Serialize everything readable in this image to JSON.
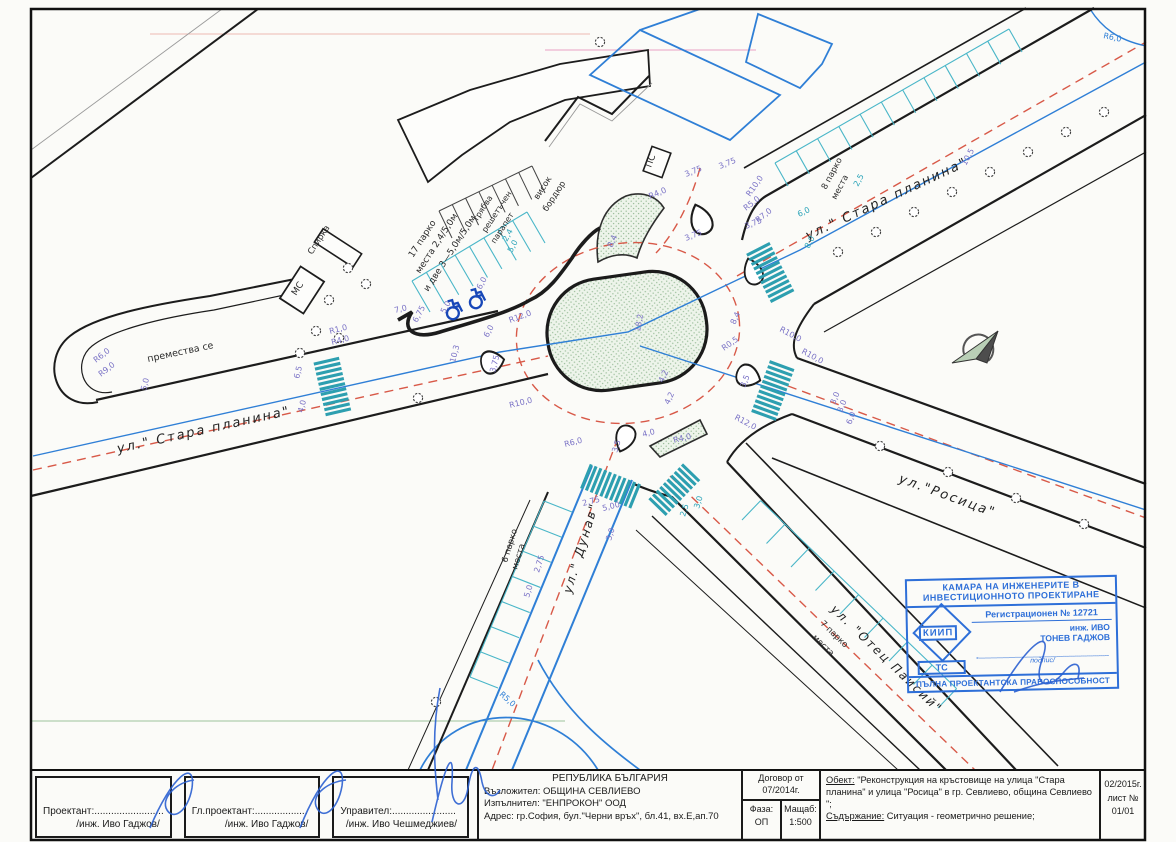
{
  "sheet_title": "Ситуация - геометрично решение",
  "colors": {
    "road_edge": "#1c1c1c",
    "centerline_red": "#d85948",
    "survey_blue": "#2f7fd6",
    "parking_cyan": "#49b6c8",
    "dimension_purple": "#7a72c6",
    "stamp_blue": "#2e6fd8",
    "island_green": "#9dbf9d"
  },
  "title_block": {
    "designer": {
      "label": "Проектант:.........................",
      "name": "/инж. Иво Гаджов/"
    },
    "chief_designer": {
      "label": "Гл.проектант:...................",
      "name": "/инж. Иво Гаджов/"
    },
    "manager": {
      "label": "Управител:.......................",
      "name": "/инж. Иво Чешмеджиев/"
    },
    "country": "РЕПУБЛИКА БЪЛГАРИЯ",
    "client": "Възложител: ОБЩИНА СЕВЛИЕВО",
    "contractor": "Изпълнител: \"ЕНПРОКОН\" ООД",
    "address": "Адрес: гр.София, бул.\"Черни връх\", бл.41, вх.Е,ап.70",
    "contract": {
      "line1": "Договор от",
      "line2": "07/2014г."
    },
    "phase": {
      "label": "Фаза:",
      "value": "ОП"
    },
    "scale": {
      "label": "Мащаб:",
      "value": "1:500"
    },
    "object": {
      "label": "Обект:",
      "text": " \"Реконструкция на кръстовище на улица \"Стара планина\" и улица \"Росица\" в гр. Севлиево, община Севлиево \";"
    },
    "content": {
      "label": "Съдържание:",
      "text": " Ситуация - геометрично решение;"
    },
    "sheet": {
      "date": "02/2015г.",
      "sheet_label": "лист №",
      "sheet_no": "01/01"
    }
  },
  "stamp": {
    "header1": "КАМАРА НА ИНЖЕНЕРИТЕ В",
    "header2": "ИНВЕСТИЦИОННОТО ПРОЕКТИРАНЕ",
    "registration": "Регистрационен № 12721",
    "name1": "инж. ИВО",
    "name2": "ТОНЕВ ГАДЖОВ",
    "logo": "КИИП",
    "section": "ТС",
    "signature_label": "подпис/",
    "footer": "ПЪЛНА ПРОЕКТАНТСКА ПРАВОСПОСОБНОСТ"
  },
  "plan": {
    "annotations": [
      {
        "t": "ул.\" Стара планина\"",
        "x": 118,
        "y": 453,
        "r": -12.5,
        "c": "street",
        "s": 13,
        "n": "street-label-stara-planina-west"
      },
      {
        "t": "ул.\" Стара планина\"",
        "x": 808,
        "y": 240,
        "r": -25,
        "c": "street",
        "s": 13,
        "n": "street-label-stara-planina-ne"
      },
      {
        "t": "ул.\"Росица\"",
        "x": 898,
        "y": 482,
        "r": 20,
        "c": "street",
        "s": 13,
        "n": "street-label-rositsa"
      },
      {
        "t": "ул.\" Дунав\"",
        "x": 571,
        "y": 594,
        "r": -73,
        "c": "street",
        "s": 12,
        "n": "street-label-dunav"
      },
      {
        "t": "ул. \"Отец Паисий\"",
        "x": 830,
        "y": 610,
        "r": 44,
        "c": "street",
        "s": 12,
        "n": "street-label-otets-paisiy"
      },
      {
        "t": "премества се",
        "x": 148,
        "y": 362,
        "r": -12,
        "c": "note",
        "s": 9.5,
        "n": "note-relocate"
      },
      {
        "t": "Спирка",
        "x": 312,
        "y": 255,
        "r": -57,
        "c": "note",
        "s": 8.5,
        "n": "note-bus-stop"
      },
      {
        "t": "МС",
        "x": 296,
        "y": 296,
        "r": -57,
        "c": "note",
        "s": 9,
        "n": "note-ms"
      },
      {
        "t": "ПС",
        "x": 651,
        "y": 168,
        "r": -70,
        "c": "note",
        "s": 9,
        "n": "note-ps"
      },
      {
        "t": "17 парко",
        "x": 413,
        "y": 258,
        "r": -57,
        "c": "note",
        "s": 9,
        "n": "note-17-parking-1"
      },
      {
        "t": "места 2,4/5,0м",
        "x": 420,
        "y": 274,
        "r": -57,
        "c": "note",
        "s": 9,
        "n": "note-17-parking-2"
      },
      {
        "t": "и две 3—5,0м/5,0м",
        "x": 428,
        "y": 292,
        "r": -57,
        "c": "note",
        "s": 9,
        "n": "note-17-parking-3"
      },
      {
        "t": "трябва",
        "x": 477,
        "y": 222,
        "r": -57,
        "c": "note",
        "s": 8,
        "n": "note-railing-1"
      },
      {
        "t": "решетъчен",
        "x": 486,
        "y": 233,
        "r": -57,
        "c": "note",
        "s": 8,
        "n": "note-railing-2"
      },
      {
        "t": "парапет",
        "x": 495,
        "y": 244,
        "r": -57,
        "c": "note",
        "s": 8,
        "n": "note-railing-3"
      },
      {
        "t": "висок",
        "x": 538,
        "y": 200,
        "r": -57,
        "c": "note",
        "s": 8.5,
        "n": "note-high-curb-1"
      },
      {
        "t": "бордюр",
        "x": 547,
        "y": 212,
        "r": -57,
        "c": "note",
        "s": 8.5,
        "n": "note-high-curb-2"
      },
      {
        "t": "8 парко",
        "x": 826,
        "y": 190,
        "r": -62,
        "c": "note",
        "s": 8.5,
        "n": "note-8-parking-1"
      },
      {
        "t": "места",
        "x": 836,
        "y": 200,
        "r": -62,
        "c": "note",
        "s": 8.5,
        "n": "note-8-parking-2"
      },
      {
        "t": "6 парко",
        "x": 507,
        "y": 563,
        "r": -73,
        "c": "note",
        "s": 8.5,
        "n": "note-6-parking-1"
      },
      {
        "t": "места",
        "x": 517,
        "y": 570,
        "r": -73,
        "c": "note",
        "s": 8.5,
        "n": "note-6-parking-2"
      },
      {
        "t": "7 парко",
        "x": 820,
        "y": 624,
        "r": 44,
        "c": "note",
        "s": 8.5,
        "n": "note-7-parking-1"
      },
      {
        "t": "места",
        "x": 812,
        "y": 638,
        "r": 44,
        "c": "note",
        "s": 8.5,
        "n": "note-7-parking-2"
      },
      {
        "t": "3,75",
        "x": 686,
        "y": 177,
        "r": -22
      },
      {
        "t": "3,75",
        "x": 720,
        "y": 169,
        "r": -22
      },
      {
        "t": "3,75",
        "x": 686,
        "y": 241,
        "r": -22
      },
      {
        "t": "3,75",
        "x": 746,
        "y": 229,
        "r": -22
      },
      {
        "t": "R4,0",
        "x": 650,
        "y": 199,
        "r": -22
      },
      {
        "t": "R10,0",
        "x": 750,
        "y": 197,
        "r": -55
      },
      {
        "t": "R5,0",
        "x": 746,
        "y": 211,
        "r": -38
      },
      {
        "t": "R7,0",
        "x": 758,
        "y": 223,
        "r": -38
      },
      {
        "t": "8,4",
        "x": 612,
        "y": 248,
        "r": -65
      },
      {
        "t": "8,4",
        "x": 735,
        "y": 325,
        "r": -65
      },
      {
        "t": "18,2",
        "x": 640,
        "y": 332,
        "r": -80
      },
      {
        "t": "4,2",
        "x": 663,
        "y": 383,
        "r": -65
      },
      {
        "t": "4,2",
        "x": 669,
        "y": 405,
        "r": -65
      },
      {
        "t": "R0,5",
        "x": 724,
        "y": 351,
        "r": -35
      },
      {
        "t": "R6,0",
        "x": 96,
        "y": 363,
        "r": -38
      },
      {
        "t": "R9,0",
        "x": 101,
        "y": 377,
        "r": -38
      },
      {
        "t": "5,0",
        "x": 146,
        "y": 391,
        "r": -76
      },
      {
        "t": "6,5",
        "x": 299,
        "y": 379,
        "r": -76
      },
      {
        "t": "4,0",
        "x": 303,
        "y": 413,
        "r": -76
      },
      {
        "t": "10,3",
        "x": 455,
        "y": 363,
        "r": -76
      },
      {
        "t": "6,0",
        "x": 488,
        "y": 338,
        "r": -62
      },
      {
        "t": "3,75",
        "x": 495,
        "y": 373,
        "r": -76
      },
      {
        "t": "R10,0",
        "x": 510,
        "y": 408,
        "r": -14
      },
      {
        "t": "R1,0",
        "x": 330,
        "y": 334,
        "r": -14
      },
      {
        "t": "R4,0",
        "x": 332,
        "y": 345,
        "r": -14
      },
      {
        "t": "R12,0",
        "x": 510,
        "y": 323,
        "r": -20
      },
      {
        "t": "10,5",
        "x": 966,
        "y": 166,
        "r": -62
      },
      {
        "t": "3,0",
        "x": 835,
        "y": 405,
        "r": -68
      },
      {
        "t": "3,0",
        "x": 842,
        "y": 413,
        "r": -68
      },
      {
        "t": "6,0",
        "x": 851,
        "y": 425,
        "r": -68
      },
      {
        "t": "R10,0",
        "x": 779,
        "y": 331,
        "r": 28
      },
      {
        "t": "R10,0",
        "x": 801,
        "y": 353,
        "r": 28
      },
      {
        "t": "3,5",
        "x": 745,
        "y": 388,
        "r": -68
      },
      {
        "t": "R12,0",
        "x": 734,
        "y": 419,
        "r": 28
      },
      {
        "t": "R6,0",
        "x": 565,
        "y": 447,
        "r": -14
      },
      {
        "t": "4,0",
        "x": 643,
        "y": 437,
        "r": -14
      },
      {
        "t": "R4,0",
        "x": 674,
        "y": 443,
        "r": -14
      },
      {
        "t": "3,5",
        "x": 617,
        "y": 453,
        "r": -73
      },
      {
        "t": "2,75",
        "x": 583,
        "y": 506,
        "r": -14
      },
      {
        "t": "5,00",
        "x": 603,
        "y": 511,
        "r": -14
      },
      {
        "t": "3,0",
        "x": 611,
        "y": 541,
        "r": -73
      },
      {
        "t": "2,75",
        "x": 539,
        "y": 573,
        "r": -73
      },
      {
        "t": "5,0",
        "x": 529,
        "y": 598,
        "r": -73
      },
      {
        "t": "7,0",
        "x": 395,
        "y": 313,
        "r": -13
      },
      {
        "t": "6,75",
        "x": 417,
        "y": 323,
        "r": -62
      },
      {
        "t": "5,0",
        "x": 445,
        "y": 314,
        "r": -62
      },
      {
        "t": "6,0",
        "x": 481,
        "y": 290,
        "r": -62
      },
      {
        "t": "R5,0",
        "x": 499,
        "y": 695,
        "r": 42,
        "c": "blue"
      },
      {
        "t": "R6,0",
        "x": 1103,
        "y": 38,
        "r": 12,
        "c": "blue"
      },
      {
        "t": "6,0",
        "x": 799,
        "y": 217,
        "r": -25,
        "c": "teal"
      },
      {
        "t": "8,0",
        "x": 809,
        "y": 249,
        "r": -62,
        "c": "teal"
      },
      {
        "t": "2,5",
        "x": 858,
        "y": 187,
        "r": -62,
        "c": "teal"
      },
      {
        "t": "2,5",
        "x": 685,
        "y": 517,
        "r": -73,
        "c": "teal"
      },
      {
        "t": "3,0",
        "x": 699,
        "y": 509,
        "r": -73,
        "c": "teal"
      },
      {
        "t": "2,4",
        "x": 507,
        "y": 242,
        "r": -62,
        "c": "teal"
      },
      {
        "t": "5,0",
        "x": 512,
        "y": 253,
        "r": -62,
        "c": "teal"
      }
    ]
  }
}
